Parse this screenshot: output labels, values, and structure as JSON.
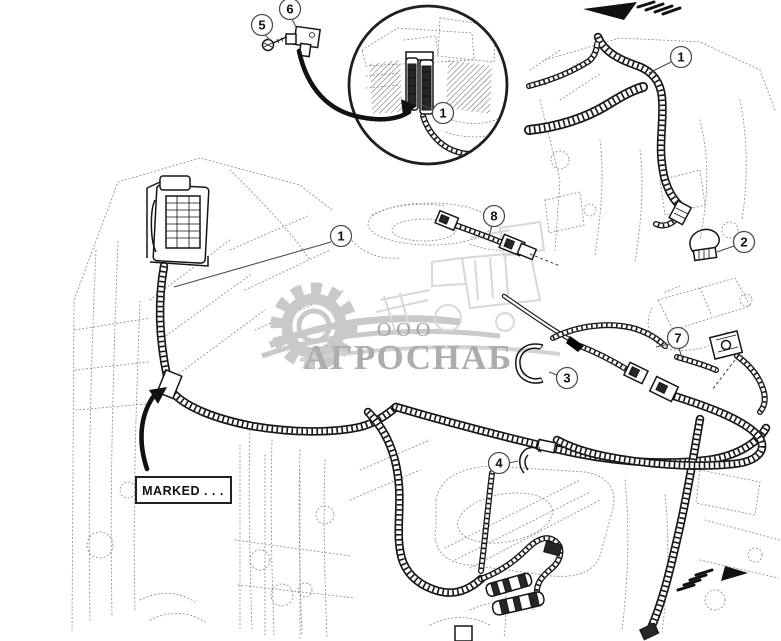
{
  "diagram": {
    "kind": "wiring-harness-parts-diagram",
    "callouts": [
      {
        "id": "5",
        "label": "5"
      },
      {
        "id": "6",
        "label": "6"
      },
      {
        "id": "1-detail",
        "label": "1"
      },
      {
        "id": "1-top-harness",
        "label": "1"
      },
      {
        "id": "1-engine-harness",
        "label": "1"
      },
      {
        "id": "2",
        "label": "2"
      },
      {
        "id": "8",
        "label": "8"
      },
      {
        "id": "7",
        "label": "7"
      },
      {
        "id": "3",
        "label": "3"
      },
      {
        "id": "4",
        "label": "4"
      }
    ],
    "labels": {
      "marked": "MARKED . . ."
    },
    "arrows": [
      {
        "name": "flow-direction-arrow-top",
        "direction": "left"
      },
      {
        "name": "flow-direction-arrow-bottom",
        "direction": "right"
      }
    ],
    "watermark": {
      "org_form": "ООО",
      "name": "АГРОСНАБ",
      "icons": [
        "gear-icon",
        "combine-harvester-icon",
        "wheat-swoosh-icon"
      ]
    },
    "colors": {
      "line": "#161616",
      "background": "#ffffff",
      "sketch": "#8f8f8f",
      "watermark_art": "#c9c9c9",
      "watermark_text": "#adadad"
    }
  }
}
